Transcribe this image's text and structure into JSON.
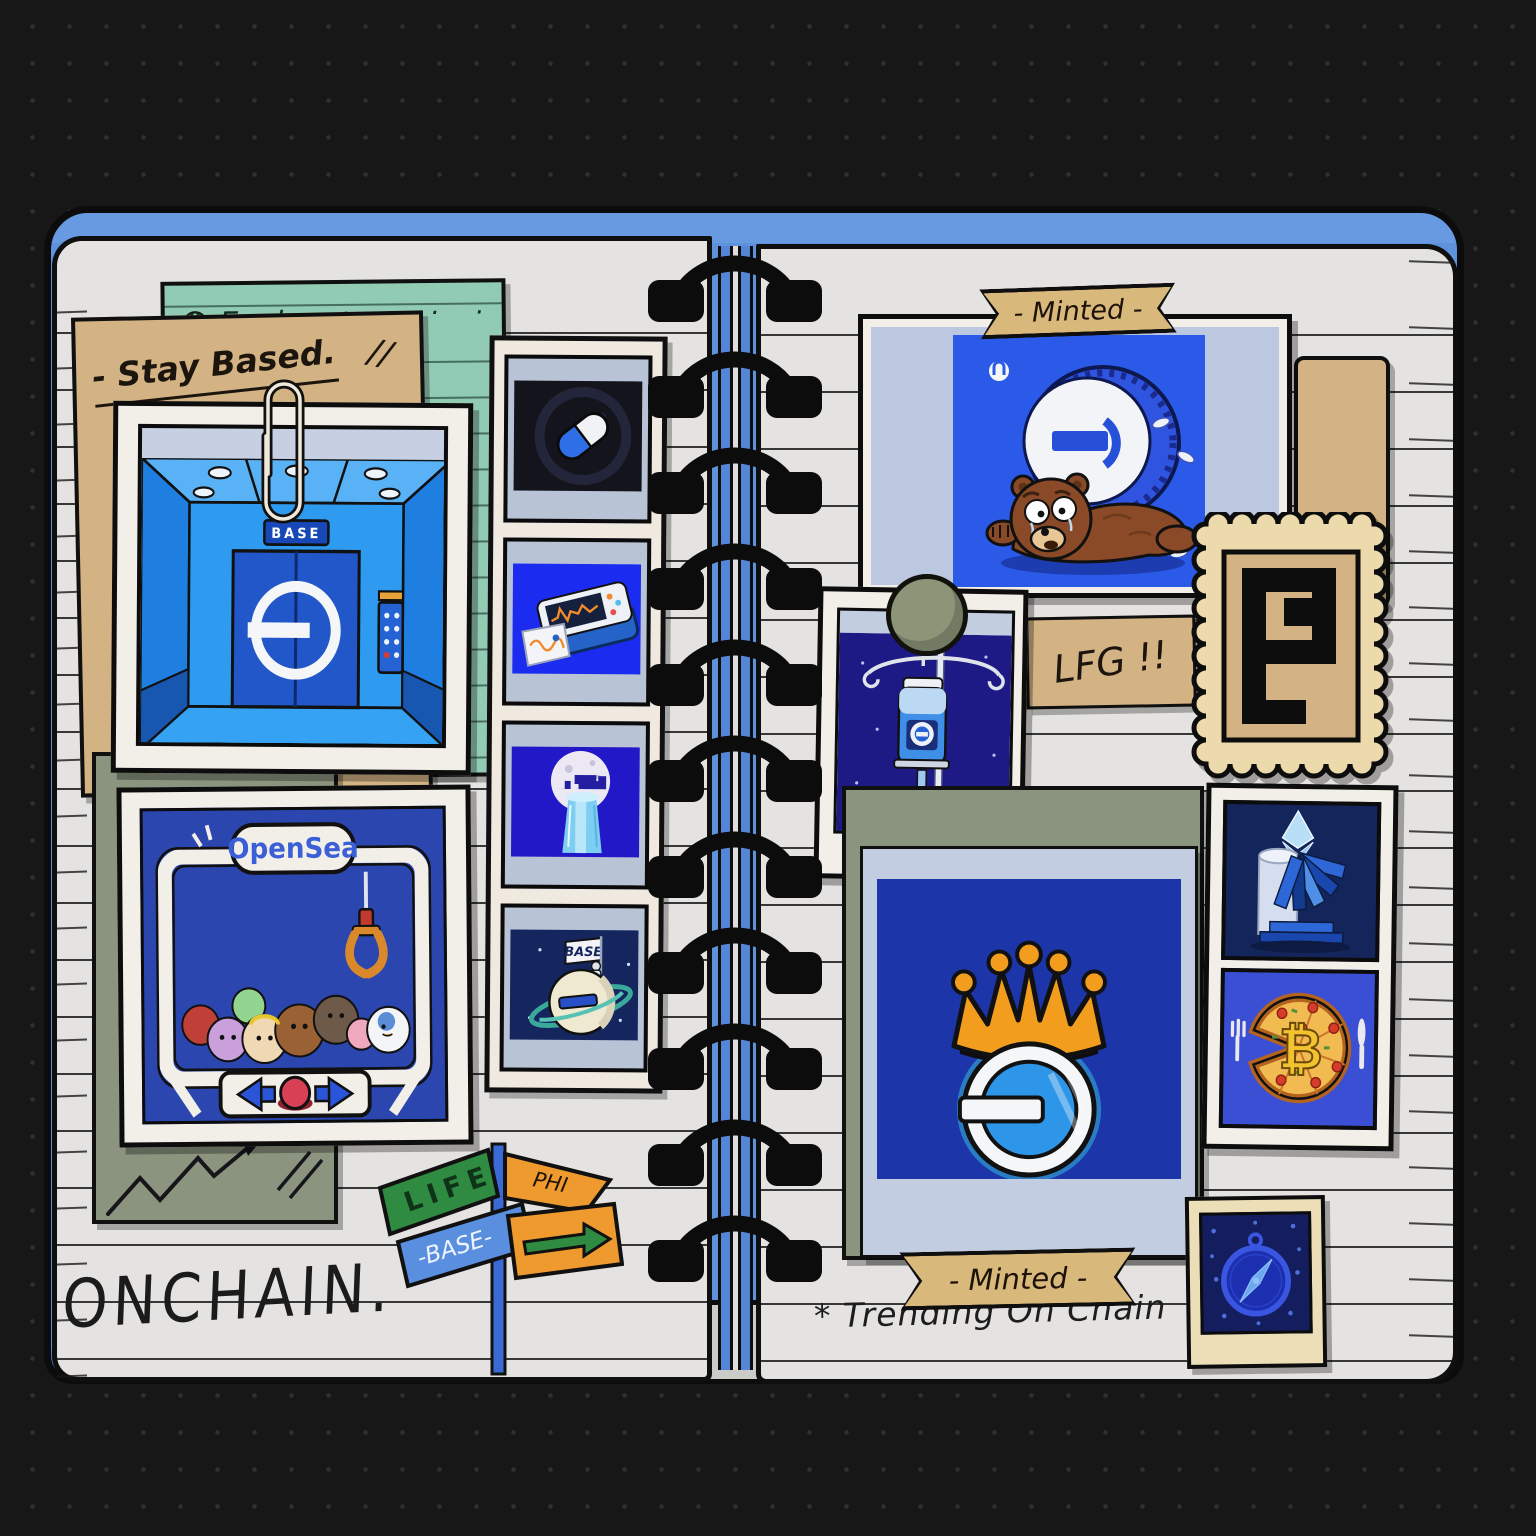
{
  "scene": {
    "description": "Hand-drawn scrapbook spread of Base-chain NFT art pinned into a spiral notebook"
  },
  "left_page": {
    "explore_label": "Explore",
    "explore_dots": ". . . . .",
    "stay_based_label": "- Stay Based.",
    "stay_based_marks": "//",
    "elevator_sign": "BASE",
    "opensea_title": "OpenSea",
    "planet_flag": "BASE",
    "signpost": {
      "life": "LIFE",
      "base": "-BASE-",
      "phi": "PHI"
    },
    "onchain": "ONCHAIN."
  },
  "right_page": {
    "minted_top": "- Minted -",
    "lfg": "LFG !!",
    "minted_bottom": "- Minted -",
    "trending": "* Trending  On  Chain",
    "pizza_symbol": "₿"
  },
  "icons": {
    "explore_note": "globe-icon",
    "photo_clip": "paperclip-icon",
    "photo_pin": "round-magnet-icon",
    "claw": "claw-machine-icon",
    "pill": "capsule-icon",
    "monitor": "heart-monitor-icon",
    "moon": "moon-waterfall-icon",
    "planet": "base-planet-icon",
    "stamp": "pixel-p-stamp-icon",
    "crown": "crown-icon",
    "eth": "ethereum-diamond-icon",
    "pizza": "bitcoin-pizza-icon",
    "compass": "compass-icon",
    "chart": "up-trend-doodle-icon"
  },
  "colors": {
    "background": "#171717",
    "cover_blue": "#5d92dc",
    "page": "#e4e3e1",
    "teal_note": "#92cbb4",
    "tan_paper": "#d3b284",
    "olive_board": "#8b947e",
    "periwinkle_mat": "#c3cde2",
    "base_blue": "#2b59e8",
    "machine_blue": "#2b46ae",
    "crown_orange": "#f29d1e",
    "stamp_cream": "#ecd9ac"
  }
}
